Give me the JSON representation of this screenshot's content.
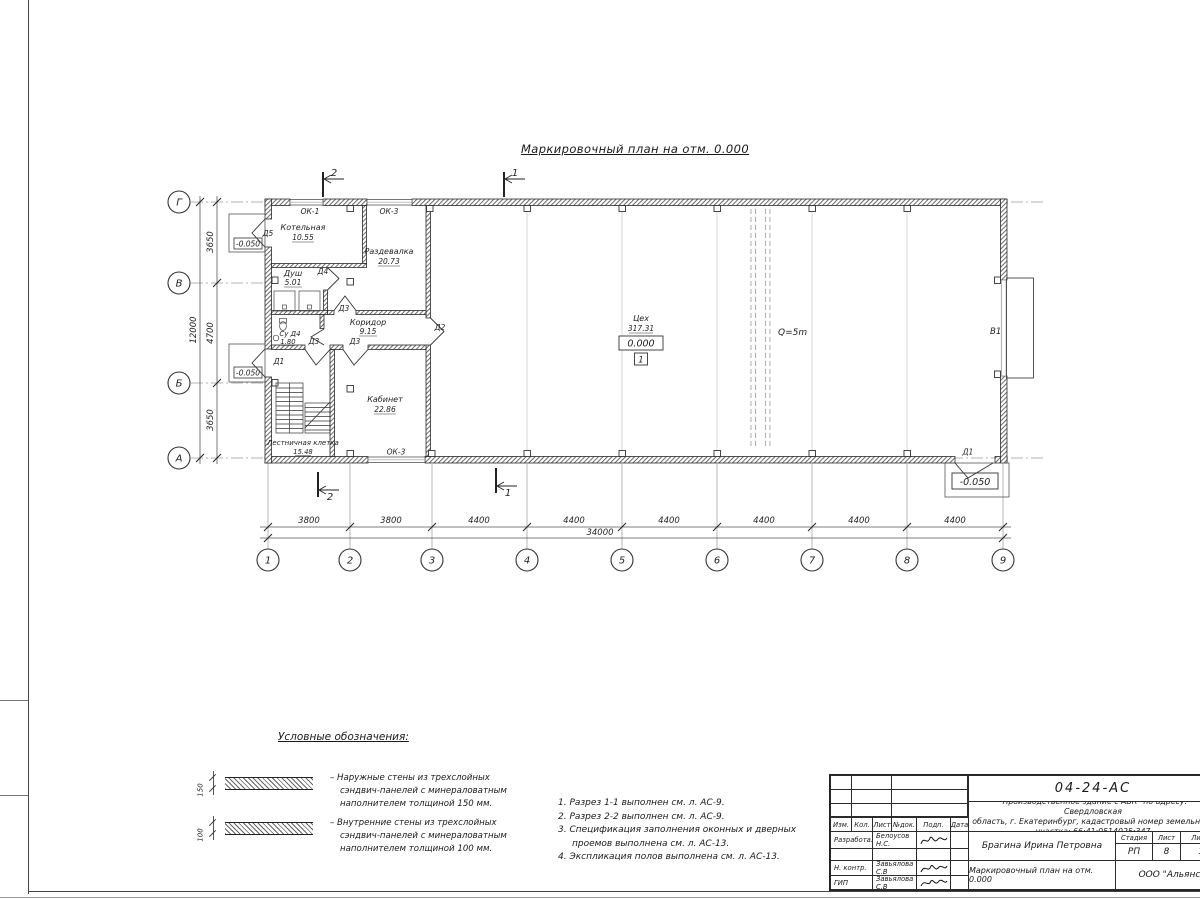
{
  "plan": {
    "title": "Маркировочный план на отм. 0.000",
    "rooms": [
      {
        "name": "Котельная",
        "area": "10.55"
      },
      {
        "name": "Раздевалка",
        "area": "20.73"
      },
      {
        "name": "Душ",
        "area": "5.01"
      },
      {
        "name": "Су Д4",
        "area": "1.80"
      },
      {
        "name": "Коридор",
        "area": "9.15"
      },
      {
        "name": "Кабинет",
        "area": "22.86"
      },
      {
        "name": "Лестничная клетка",
        "area": "15.48"
      },
      {
        "name": "Цех",
        "area": "317.31"
      }
    ],
    "levels": {
      "zero": "0.000",
      "below": "-0.050",
      "floor_mark": "1"
    },
    "openings": {
      "d1": "Д1",
      "d2": "Д2",
      "d3": "Д3",
      "d4": "Д4",
      "d5": "Д5",
      "ok1": "ОК-1",
      "ok3": "ОК-3",
      "gate": "В1"
    },
    "crane": "Q=5m",
    "sections": {
      "s1": "1",
      "s2": "2"
    }
  },
  "axes": {
    "cols": [
      "1",
      "2",
      "3",
      "4",
      "5",
      "6",
      "7",
      "8",
      "9"
    ],
    "rows": [
      "Г",
      "В",
      "Б",
      "А"
    ],
    "col_dims": [
      "3800",
      "3800",
      "4400",
      "4400",
      "4400",
      "4400",
      "4400",
      "4400"
    ],
    "col_total": "34000",
    "row_dims": [
      "3650",
      "4700",
      "3650"
    ],
    "row_total": "12000"
  },
  "legend": {
    "title": "Условные обозначения:",
    "items": [
      {
        "thickness": "150",
        "lines": [
          "– Наружные стены из трехслойных",
          "сэндвич-панелей с минераловатным",
          "наполнителем толщиной 150 мм."
        ]
      },
      {
        "thickness": "100",
        "lines": [
          "– Внутренние стены из трехслойных",
          "сэндвич-панелей с минераловатным",
          "наполнителем толщиной 100 мм."
        ]
      }
    ]
  },
  "notes": {
    "lines": [
      "1. Разрез 1-1 выполнен см. л. АС-9.",
      "2. Разрез 2-2 выполнен см. л. АС-9.",
      "3. Спецификация заполнения оконных и дверных",
      "проемов выполнена см. л. АС-13.",
      "4. Экспликация полов выполнена см. л. АС-13."
    ]
  },
  "title_block": {
    "doc_number": "04-24-АС",
    "project": [
      "\"Производственное здание с АБК\" по адресу: Свердловская",
      "область, г. Екатеринбург, кадастровый номер земельного",
      "участка: 66:41:0514025:347"
    ],
    "rev_headers": [
      "Изм.",
      "Кол.",
      "Лист",
      "№док.",
      "Подп.",
      "Дата"
    ],
    "rows": [
      {
        "role": "Разработал",
        "name": "Белоусов Н.С."
      },
      {
        "role": "Н. контр.",
        "name": "Завьялова С.В"
      },
      {
        "role": "ГИП",
        "name": "Завьялова С.В"
      }
    ],
    "client": "Брагина Ирина Петровна",
    "stage_header": "Стадия",
    "sheet_header": "Лист",
    "sheets_header": "Листов",
    "stage": "РП",
    "sheet": "8",
    "sheets": "13",
    "drawing_title": "Маркировочный план на отм. 0.000",
    "organization": "ООО \"Альянс\""
  }
}
